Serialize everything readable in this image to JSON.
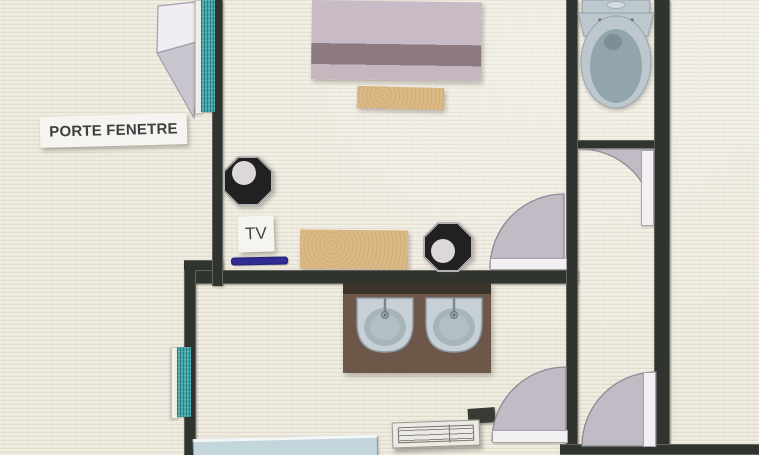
{
  "scene": {
    "type": "hand-made floor plan collage (paper cut-outs on textured canvas)",
    "background_color": "#ece8db",
    "wall_color": "#30342e"
  },
  "labels": {
    "porte_fenetre": "PORTE FENETRE",
    "tv": "TV"
  },
  "colors": {
    "window_teal": "#43a9ad",
    "door_swing_gray": "#c0bbc5",
    "door_leaf_white": "#f2f0f3",
    "bed_light_mauve": "#c8bbc6",
    "bed_band_mauve": "#8c7a80",
    "bench_tan": "#dcb884",
    "tv_stand_indigo": "#312c96",
    "vanity_brown": "#6d5748",
    "porcelain_gray_blue": "#bdc7ce",
    "bathtub_blue": "#c2d6dc",
    "octagon_dark": "#212121",
    "label_background": "#f6f4f0"
  },
  "rooms": {
    "bedroom": {
      "name": "bedroom",
      "items": [
        "porte-fenetre (french window with swing triangle and teal glazing strip)",
        "double bed",
        "bench at foot of bed",
        "octagon side table (left)",
        "octagon side table (right)",
        "TV with indigo stand bar",
        "tan credenza bench",
        "entry door with quarter-circle swing"
      ]
    },
    "wc": {
      "name": "wc",
      "items": [
        "toilet (top view)",
        "door swinging into hallway"
      ]
    },
    "bathroom": {
      "name": "bathroom",
      "items": [
        "double-sink brown vanity",
        "bathtub (bottom edge)",
        "floor vent grate",
        "teal window strip on left wall",
        "door with quarter-circle swing"
      ]
    },
    "hallway": {
      "name": "hallway",
      "items": [
        "entrance door with quarter-circle swing (bottom right)"
      ]
    }
  }
}
